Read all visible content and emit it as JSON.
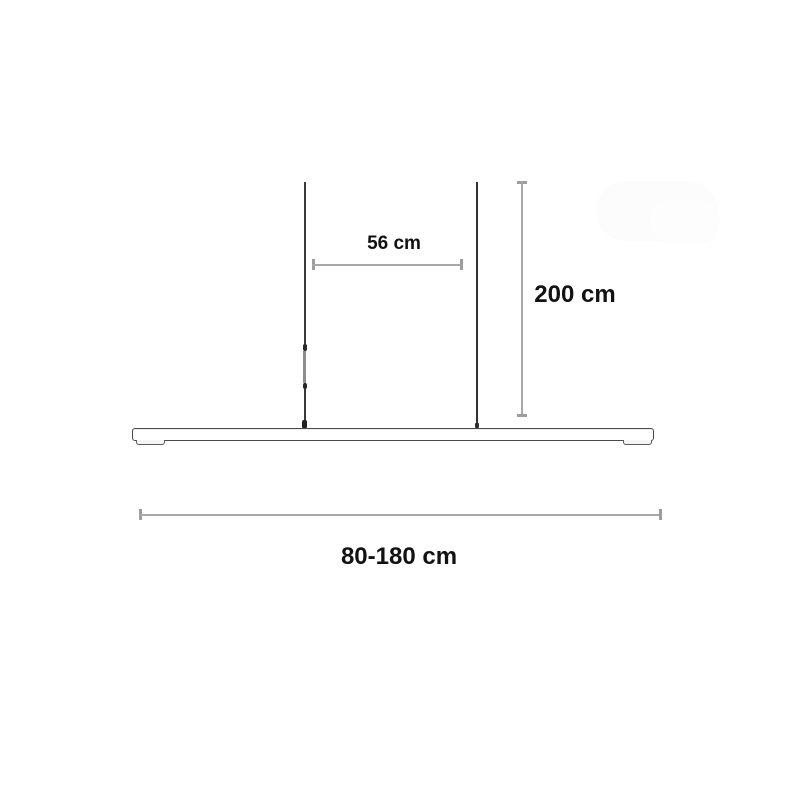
{
  "diagram": {
    "kind": "pendant-lamp-dimension-diagram",
    "labels": {
      "cable_spacing": "56 cm",
      "drop_height": "200 cm",
      "bar_width_range": "80-180 cm"
    },
    "colors": {
      "background": "#ffffff",
      "text": "#121212",
      "dimension_line": "#a8a8a8",
      "dimension_cap": "#9d9d9d",
      "cable": "#3a3a3a",
      "bar_outline": "#4a4a4a",
      "bar_fill": "#ffffff"
    }
  }
}
